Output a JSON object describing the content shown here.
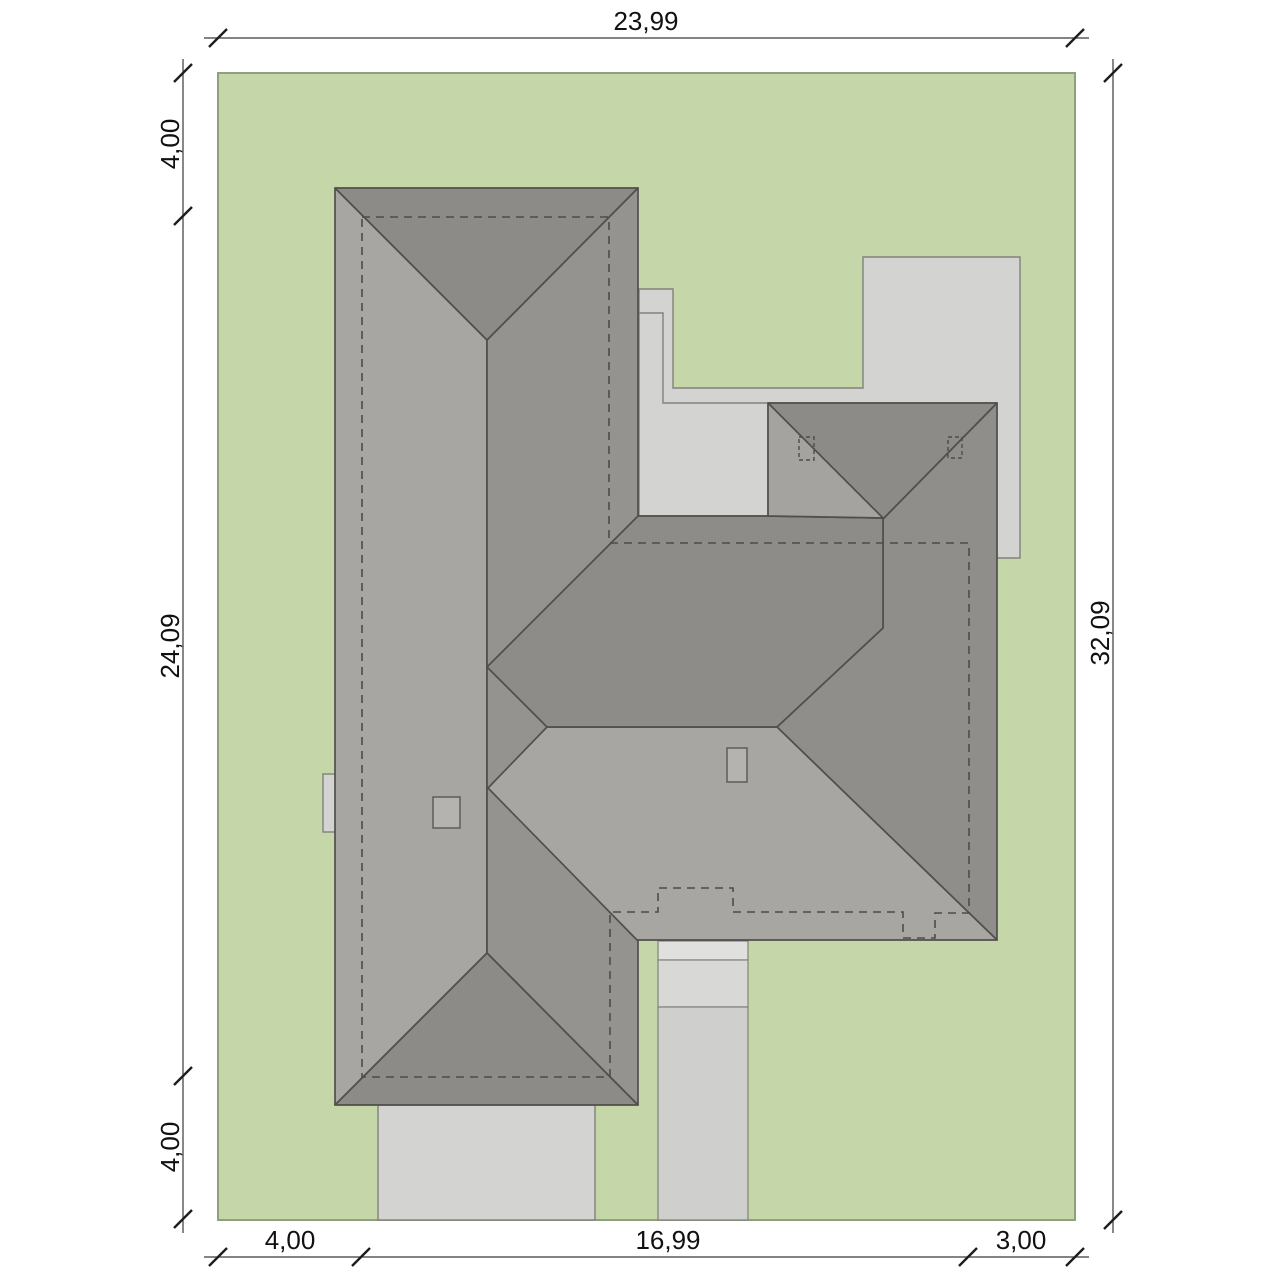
{
  "drawing": {
    "kind": "house-site-plan-roof-view"
  },
  "dimensions": {
    "top_width": "23,99",
    "left_top_setback": "4,00",
    "left_house_length": "24,09",
    "left_bottom_setback": "4,00",
    "right_height": "32,09",
    "bottom_left_setback": "4,00",
    "bottom_house_width": "16,99",
    "bottom_right_setback": "3,00"
  },
  "colors": {
    "background": "#ffffff",
    "plot_green": "#c5d6a9",
    "plot_border": "#8fa07f",
    "paving_gray": "#d3d3d1",
    "paving_light": "#e0e0de",
    "roof_light_slope": "#a8a6a3",
    "roof_mid_slope": "#95938f",
    "roof_dark_slope": "#8d8b87",
    "roof_edge": "#514f4c",
    "dashed_wall": "#4e4c49",
    "dimension_text": "#111111"
  }
}
